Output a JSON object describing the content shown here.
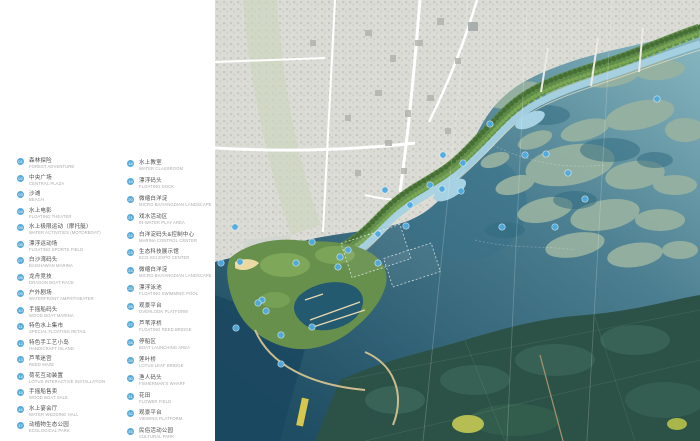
{
  "legend": {
    "accent_color": "#58abd8",
    "columns": [
      {
        "items": [
          {
            "num": "01",
            "zh": "森林探险",
            "en": "FOREST ADVENTURE"
          },
          {
            "num": "02",
            "zh": "中央广场",
            "en": "CENTRAL PLAZA"
          },
          {
            "num": "03",
            "zh": "沙滩",
            "en": "BEACH"
          },
          {
            "num": "04",
            "zh": "水上电影",
            "en": "FLOATING THEATER"
          },
          {
            "num": "05",
            "zh": "水上极限运动（摩托艇）",
            "en": "WATER ACTIVITIES (MOTORBOAT)"
          },
          {
            "num": "06",
            "zh": "漂浮运动场",
            "en": "FLOATING SPORTS FIELD"
          },
          {
            "num": "07",
            "zh": "白沙湾码头",
            "en": "BAISHAWAN MARINA"
          },
          {
            "num": "08",
            "zh": "龙舟竞技",
            "en": "DRAGON BOAT RACE"
          },
          {
            "num": "09",
            "zh": "户外剧场",
            "en": "WATERFRONT AMPHITHEATER"
          },
          {
            "num": "10",
            "zh": "手摇船码头",
            "en": "WOOD BOAT MARINA"
          },
          {
            "num": "11",
            "zh": "特色水上集市",
            "en": "SPECIAL FLOATING RETAIL"
          },
          {
            "num": "12",
            "zh": "特色手工艺小岛",
            "en": "HANDICRAFT ISLAND"
          },
          {
            "num": "13",
            "zh": "芦苇迷宫",
            "en": "REED MAZE"
          },
          {
            "num": "14",
            "zh": "荷花互动装置",
            "en": "LOTUS INTERACTIVE INSTALLATION"
          },
          {
            "num": "15",
            "zh": "手摇船售卖",
            "en": "WOOD BOAT SALE"
          },
          {
            "num": "16",
            "zh": "水上宴会厅",
            "en": "WATER WEDDING HALL"
          },
          {
            "num": "17",
            "zh": "动植物生态公园",
            "en": "ECOLOGICAL PARK"
          }
        ]
      },
      {
        "items": [
          {
            "num": "18",
            "zh": "水上教室",
            "en": "WATER CLASSROOM"
          },
          {
            "num": "19",
            "zh": "漂浮码头",
            "en": "FLOATING DOCK"
          },
          {
            "num": "20",
            "zh": "微缩白洋淀",
            "en": "MICRO BAIYANGDIAN LANDSCAPE"
          },
          {
            "num": "21",
            "zh": "戏水活动区",
            "en": "IN-WATER PLAY AREA"
          },
          {
            "num": "22",
            "zh": "白洋淀码头&控制中心",
            "en": "MARINA CONTROL CENTER"
          },
          {
            "num": "23",
            "zh": "生态科技展示馆",
            "en": "ECO-SCI EXPO CENTER"
          },
          {
            "num": "24",
            "zh": "微缩白洋淀",
            "en": "MICRO BAIYANGDIAN LANDSCAPE"
          },
          {
            "num": "25",
            "zh": "漂浮泳池",
            "en": "FLOATING SWIMMING POOL"
          },
          {
            "num": "26",
            "zh": "观景平台",
            "en": "OVERLOOK PLATFORM"
          },
          {
            "num": "27",
            "zh": "芦苇浮桥",
            "en": "FLOATING REED BRIDGE"
          },
          {
            "num": "28",
            "zh": "停船区",
            "en": "BOAT LAUNCHING AREA"
          },
          {
            "num": "29",
            "zh": "莲叶桥",
            "en": "LOTUS LEAF BRIDGE"
          },
          {
            "num": "30",
            "zh": "渔人码头",
            "en": "FISHERMAN'S WHARF"
          },
          {
            "num": "31",
            "zh": "花田",
            "en": "FLOWER FIELD"
          },
          {
            "num": "32",
            "zh": "观景平台",
            "en": "VIEWING PLATFORM"
          },
          {
            "num": "33",
            "zh": "民俗活动公园",
            "en": "CULTURAL PARK"
          }
        ]
      }
    ]
  },
  "map": {
    "colors": {
      "marker_blue": "#4fabdf",
      "water_deep": "#1f4d63",
      "water_mid": "#4b7e90",
      "wetland_light": "#8fbec6",
      "island_sage": "#97b2a1",
      "city_grey": "#dcdcd7",
      "corridor_green": "#5d8a44",
      "channel_blue": "#a6d2e3",
      "forest_dark": "#2c5147",
      "beach_sand": "#ead9a2"
    },
    "markers": [
      [
        20,
        227
      ],
      [
        6,
        263
      ],
      [
        25,
        262
      ],
      [
        47,
        300
      ],
      [
        43,
        303
      ],
      [
        51,
        311
      ],
      [
        21,
        328
      ],
      [
        66,
        335
      ],
      [
        66,
        364
      ],
      [
        97,
        327
      ],
      [
        81,
        263
      ],
      [
        97,
        242
      ],
      [
        123,
        267
      ],
      [
        125,
        257
      ],
      [
        133,
        250
      ],
      [
        163,
        263
      ],
      [
        163,
        234
      ],
      [
        191,
        226
      ],
      [
        170,
        190
      ],
      [
        195,
        205
      ],
      [
        215,
        185
      ],
      [
        227,
        189
      ],
      [
        228,
        155
      ],
      [
        248,
        163
      ],
      [
        246,
        191
      ],
      [
        275,
        124
      ],
      [
        287,
        227
      ],
      [
        310,
        155
      ],
      [
        331,
        154
      ],
      [
        353,
        173
      ],
      [
        370,
        199
      ],
      [
        340,
        227
      ],
      [
        442,
        99
      ]
    ]
  }
}
